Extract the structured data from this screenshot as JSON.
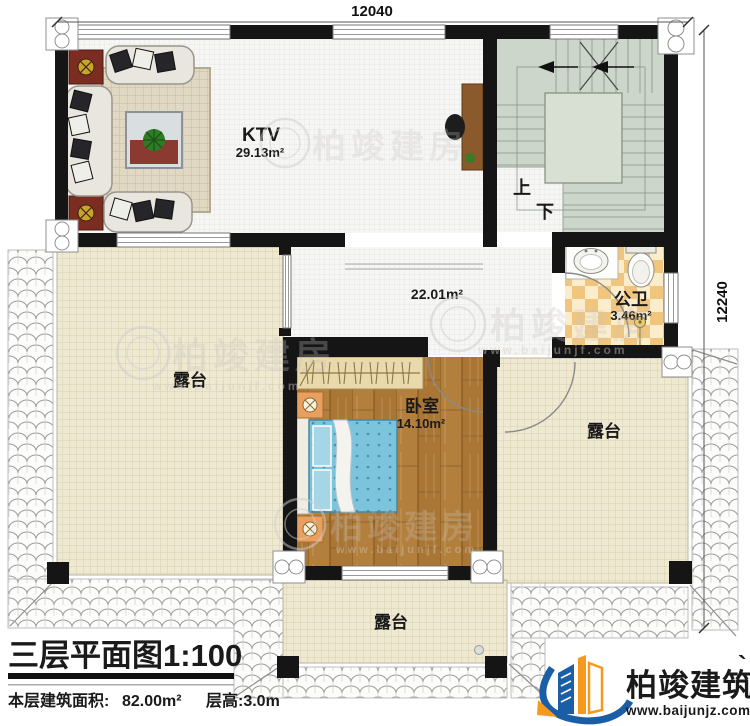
{
  "dims": {
    "top": "12040",
    "right": "12240"
  },
  "rooms": {
    "ktv": {
      "name": "KTV",
      "area": "29.13m²"
    },
    "hall": {
      "area": "22.01m²"
    },
    "bathroom": {
      "name": "公卫",
      "area": "3.46m²"
    },
    "bedroom": {
      "name": "卧室",
      "area": "14.10m²"
    },
    "terrace_left": {
      "name": "露台"
    },
    "terrace_right": {
      "name": "露台"
    },
    "terrace_bottom": {
      "name": "露台"
    }
  },
  "stairs": {
    "up_label": "上",
    "down_label": "下"
  },
  "watermark": {
    "brand": "柏竣建房",
    "site": "www.baijunjf.com"
  },
  "title_block": {
    "title": "三层平面图1:100",
    "area_label": "本层建筑面积:",
    "area_value": "82.00m²",
    "height_label": "层高:3.0m"
  },
  "logo": {
    "brand": "柏竣建筑",
    "tick": "`",
    "site": "www.baijunjz.com"
  }
}
